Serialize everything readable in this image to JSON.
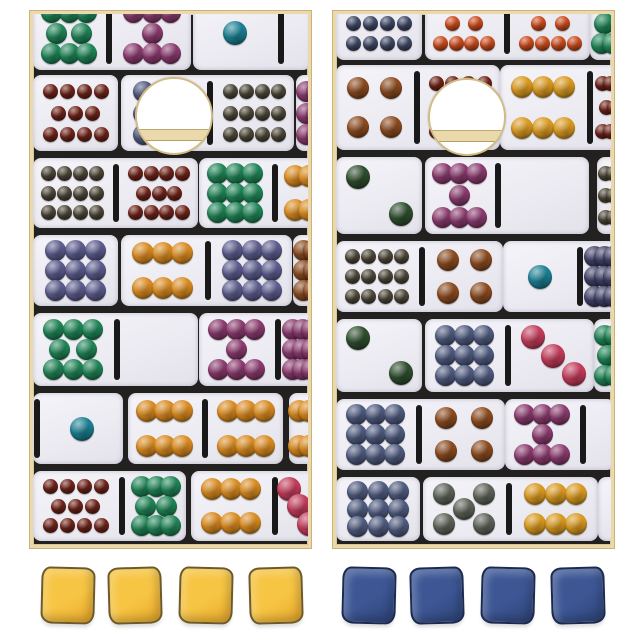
{
  "image": {
    "description": "Domino themed cornhole set product photo: two cornhole boards printed with a collage of white dominoes with multicolor pips, each board with a round hole near the top, four yellow bean bags under the left board and four blue bean bags under the right board",
    "background": "#ffffff"
  },
  "palette": {
    "frame": "#ead9ac",
    "frame_edge": "#cdb177",
    "board_gap": "#23211f",
    "tile": "#efeef4",
    "divider": "#191919",
    "hole_ring": "#d2bc84",
    "hole_band": "#ead9ab",
    "pips": {
      "green": "#1f8456",
      "darkgreen": "#2e4d2e",
      "purple": "#8a3a6e",
      "teal": "#1b7f93",
      "brown": "#6e2318",
      "olive": "#4c4637",
      "lavender": "#5c5c8e",
      "slate": "#4e5a7e",
      "navy": "#3e4764",
      "orangered": "#cc4a1b",
      "orange": "#d98a1f",
      "yellow": "#d9991f",
      "rust": "#8a4a1f",
      "pink": "#c23b5a",
      "olivegray": "#5c6257",
      "violet": "#3f3f66"
    }
  },
  "boards": [
    {
      "id": "left",
      "x": 30,
      "y": 11,
      "w": 281,
      "h": 537,
      "hole": {
        "cx": 141,
        "cy": 102,
        "r": 37,
        "band_dy": 11,
        "band_h": 10
      },
      "rows": [
        {
          "y": 0,
          "h": 58,
          "crop": true,
          "tiles": [
            {
              "x": 0,
              "halves": [
                {
                  "n": 8,
                  "c": "green",
                  "w": 72
                },
                {
                  "n": 7,
                  "c": "purple",
                  "w": 78
                }
              ]
            },
            {
              "x": 160,
              "halves": [
                {
                  "n": 1,
                  "c": "teal",
                  "w": 84
                },
                {
                  "n": 0,
                  "c": "",
                  "w": 26
                }
              ]
            }
          ]
        },
        {
          "y": 58,
          "h": 83,
          "tiles": [
            {
              "x": 0,
              "halves": [
                {
                  "n": 11,
                  "c": "brown",
                  "w": 85
                }
              ]
            },
            {
              "x": 88,
              "halves": [
                {
                  "n": 9,
                  "c": "slate",
                  "w": 85
                },
                {
                  "n": 12,
                  "c": "olive",
                  "w": 80
                }
              ]
            },
            {
              "x": 263,
              "halves": [
                {
                  "n": 9,
                  "c": "purple",
                  "w": 40
                }
              ]
            }
          ]
        },
        {
          "y": 141,
          "h": 77,
          "tiles": [
            {
              "x": 0,
              "halves": [
                {
                  "n": 12,
                  "c": "olive",
                  "w": 79
                },
                {
                  "n": 11,
                  "c": "brown",
                  "w": 78
                }
              ]
            },
            {
              "x": 166,
              "halves": [
                {
                  "n": 9,
                  "c": "green",
                  "w": 72
                },
                {
                  "n": 6,
                  "c": "orange",
                  "w": 60
                }
              ]
            }
          ]
        },
        {
          "y": 218,
          "h": 78,
          "tiles": [
            {
              "x": 0,
              "halves": [
                {
                  "n": 9,
                  "c": "lavender",
                  "w": 85
                }
              ]
            },
            {
              "x": 88,
              "halves": [
                {
                  "n": 6,
                  "c": "orange",
                  "w": 83
                },
                {
                  "n": 9,
                  "c": "lavender",
                  "w": 80
                }
              ]
            },
            {
              "x": 260,
              "halves": [
                {
                  "n": 9,
                  "c": "rust",
                  "w": 40
                }
              ]
            }
          ]
        },
        {
          "y": 296,
          "h": 80,
          "tiles": [
            {
              "x": 0,
              "halves": [
                {
                  "n": 8,
                  "c": "green",
                  "w": 80
                },
                {
                  "n": 0,
                  "c": "",
                  "w": 77
                }
              ]
            },
            {
              "x": 166,
              "halves": [
                {
                  "n": 7,
                  "c": "purple",
                  "w": 75
                },
                {
                  "n": 9,
                  "c": "purple",
                  "w": 40
                }
              ]
            }
          ]
        },
        {
          "y": 376,
          "h": 78,
          "tiles": [
            {
              "x": 0,
              "lead": true,
              "halves": [
                {
                  "n": 1,
                  "c": "teal",
                  "w": 82
                }
              ]
            },
            {
              "x": 95,
              "halves": [
                {
                  "n": 6,
                  "c": "orange",
                  "w": 73
                },
                {
                  "n": 6,
                  "c": "orange",
                  "w": 74
                }
              ]
            },
            {
              "x": 256,
              "halves": [
                {
                  "n": 6,
                  "c": "orange",
                  "w": 40
                }
              ]
            }
          ]
        },
        {
          "y": 454,
          "h": 77,
          "tiles": [
            {
              "x": 0,
              "halves": [
                {
                  "n": 11,
                  "c": "brown",
                  "w": 85
                },
                {
                  "n": 8,
                  "c": "green",
                  "w": 60
                }
              ]
            },
            {
              "x": 158,
              "halves": [
                {
                  "n": 6,
                  "c": "orange",
                  "w": 80
                },
                {
                  "n": 3,
                  "c": "pink",
                  "w": 40
                }
              ]
            }
          ]
        }
      ]
    },
    {
      "id": "right",
      "x": 333,
      "y": 11,
      "w": 281,
      "h": 537,
      "hole": {
        "cx": 131,
        "cy": 103,
        "r": 37,
        "band_dy": 11,
        "band_h": 10
      },
      "rows": [
        {
          "y": 0,
          "h": 48,
          "crop": true,
          "tiles": [
            {
              "x": 0,
              "halves": [
                {
                  "n": 12,
                  "c": "navy",
                  "w": 86
                }
              ]
            },
            {
              "x": 89,
              "halves": [
                {
                  "n": 10,
                  "c": "orangered",
                  "w": 78
                },
                {
                  "n": 10,
                  "c": "orangered",
                  "w": 79
                }
              ]
            },
            {
              "x": 254,
              "halves": [
                {
                  "n": 8,
                  "c": "green",
                  "w": 45
                }
              ]
            }
          ]
        },
        {
          "y": 48,
          "h": 92,
          "tiles": [
            {
              "x": 0,
              "halves": [
                {
                  "n": 4,
                  "c": "rust",
                  "w": 77
                },
                {
                  "n": 11,
                  "c": "brown",
                  "w": 79
                }
              ]
            },
            {
              "x": 164,
              "halves": [
                {
                  "n": 6,
                  "c": "yellow",
                  "w": 86
                },
                {
                  "n": 11,
                  "c": "brown",
                  "w": 40
                }
              ]
            }
          ]
        },
        {
          "y": 140,
          "h": 84,
          "tiles": [
            {
              "x": 0,
              "halves": [
                {
                  "n": 2,
                  "c": "darkgreen",
                  "w": 86
                }
              ]
            },
            {
              "x": 89,
              "halves": [
                {
                  "n": 7,
                  "c": "purple",
                  "w": 69
                },
                {
                  "n": 0,
                  "c": "",
                  "w": 87
                }
              ]
            },
            {
              "x": 261,
              "halves": [
                {
                  "n": 12,
                  "c": "olive",
                  "w": 40
                }
              ]
            }
          ]
        },
        {
          "y": 224,
          "h": 78,
          "tiles": [
            {
              "x": 0,
              "halves": [
                {
                  "n": 12,
                  "c": "olive",
                  "w": 82
                },
                {
                  "n": 4,
                  "c": "rust",
                  "w": 77
                }
              ]
            },
            {
              "x": 167,
              "halves": [
                {
                  "n": 1,
                  "c": "teal",
                  "w": 73
                },
                {
                  "n": 9,
                  "c": "violet",
                  "w": 40
                }
              ]
            }
          ]
        },
        {
          "y": 302,
          "h": 80,
          "tiles": [
            {
              "x": 0,
              "halves": [
                {
                  "n": 2,
                  "c": "darkgreen",
                  "w": 86
                }
              ]
            },
            {
              "x": 89,
              "halves": [
                {
                  "n": 9,
                  "c": "slate",
                  "w": 79
                },
                {
                  "n": 3,
                  "c": "pink",
                  "w": 82
                }
              ]
            },
            {
              "x": 258,
              "halves": [
                {
                  "n": 8,
                  "c": "green",
                  "w": 40
                }
              ]
            }
          ]
        },
        {
          "y": 382,
          "h": 78,
          "tiles": [
            {
              "x": 0,
              "halves": [
                {
                  "n": 9,
                  "c": "slate",
                  "w": 79
                },
                {
                  "n": 4,
                  "c": "rust",
                  "w": 82
                }
              ]
            },
            {
              "x": 169,
              "halves": [
                {
                  "n": 7,
                  "c": "purple",
                  "w": 74
                },
                {
                  "n": 0,
                  "c": "",
                  "w": 28
                }
              ]
            }
          ]
        },
        {
          "y": 460,
          "h": 71,
          "tiles": [
            {
              "x": 0,
              "halves": [
                {
                  "n": 9,
                  "c": "slate",
                  "w": 84
                }
              ]
            },
            {
              "x": 87,
              "halves": [
                {
                  "n": 5,
                  "c": "olivegray",
                  "w": 82
                },
                {
                  "n": 6,
                  "c": "yellow",
                  "w": 85
                }
              ]
            },
            {
              "x": 262,
              "halves": [
                {
                  "n": 0,
                  "c": "",
                  "w": 30
                }
              ]
            }
          ]
        }
      ]
    }
  ],
  "bags": {
    "y": 567,
    "size": {
      "w": 54,
      "h": 57
    },
    "left": {
      "label": "yellow bean bags",
      "color": "#f7c544",
      "shade": "#e8a92c",
      "outline": "#6d5a26",
      "count": 4,
      "xs": [
        41,
        108,
        179,
        249
      ]
    },
    "right": {
      "label": "blue bean bags",
      "color": "#3d5795",
      "shade": "#2e4477",
      "outline": "#1c2a52",
      "count": 4,
      "xs": [
        342,
        410,
        481,
        551
      ]
    }
  }
}
